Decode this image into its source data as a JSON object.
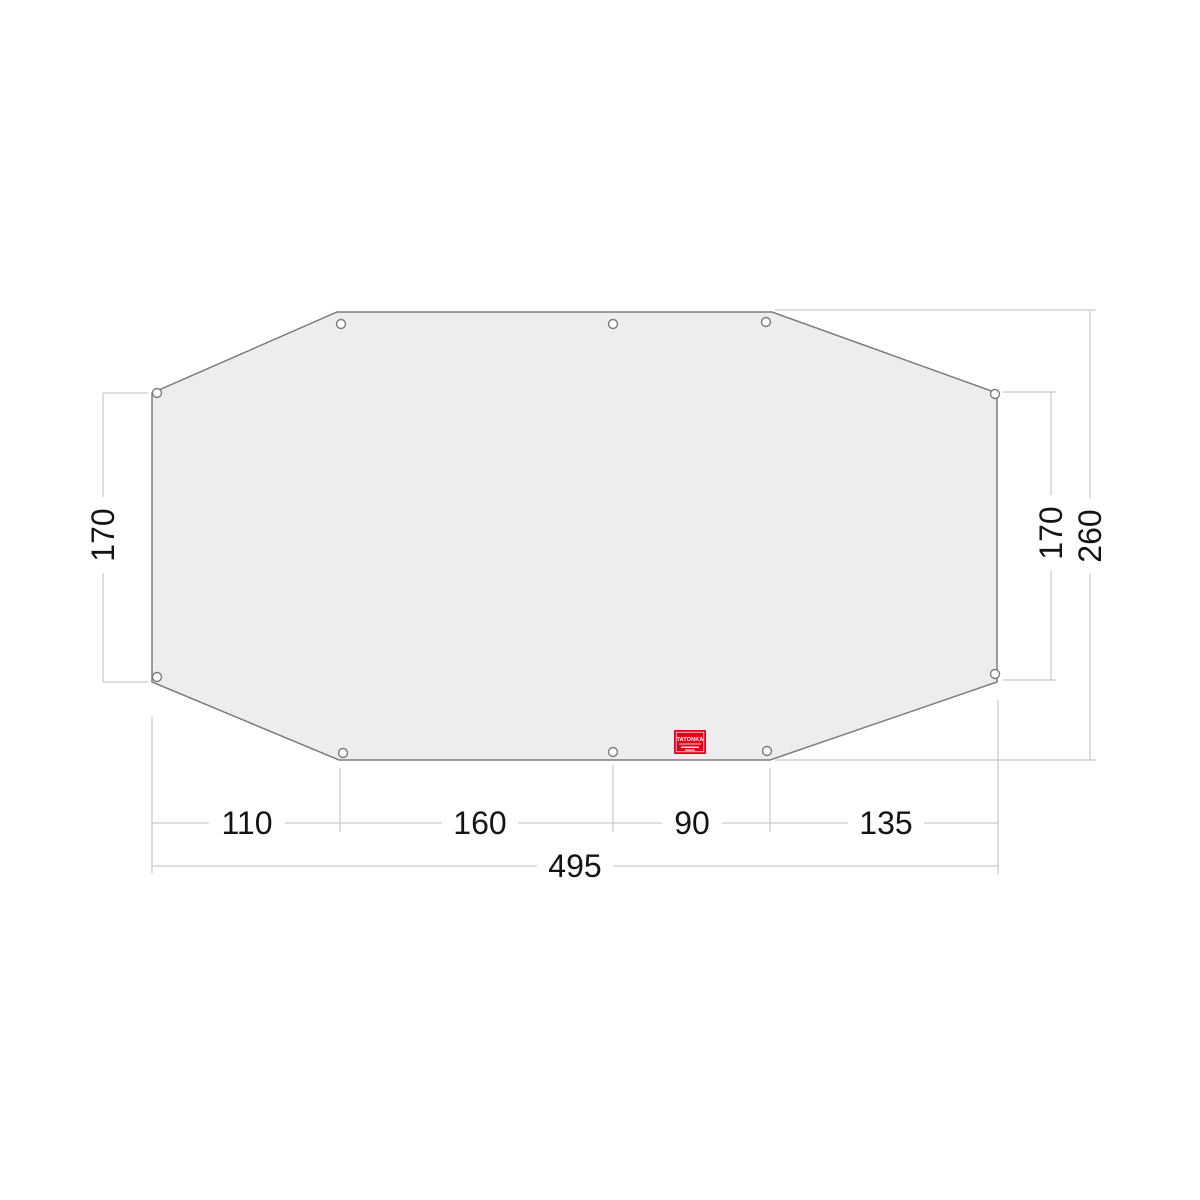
{
  "diagram": {
    "kind": "tent-footprint-dimension-drawing"
  },
  "dimensions": {
    "left_height_label": "170",
    "right_height_label": "170",
    "overall_height_label": "260",
    "bottom_segment_labels": [
      "110",
      "160",
      "90",
      "135"
    ],
    "overall_width_label": "495"
  },
  "logo": {
    "brand": "TATONKA"
  },
  "colors": {
    "panel_fill": "#ededed",
    "panel_outline": "#7c7c7c",
    "dimension_line": "#c9c9c9",
    "dimension_text": "#141414",
    "logo_red": "#e2001a",
    "logo_text": "#ffffff"
  }
}
